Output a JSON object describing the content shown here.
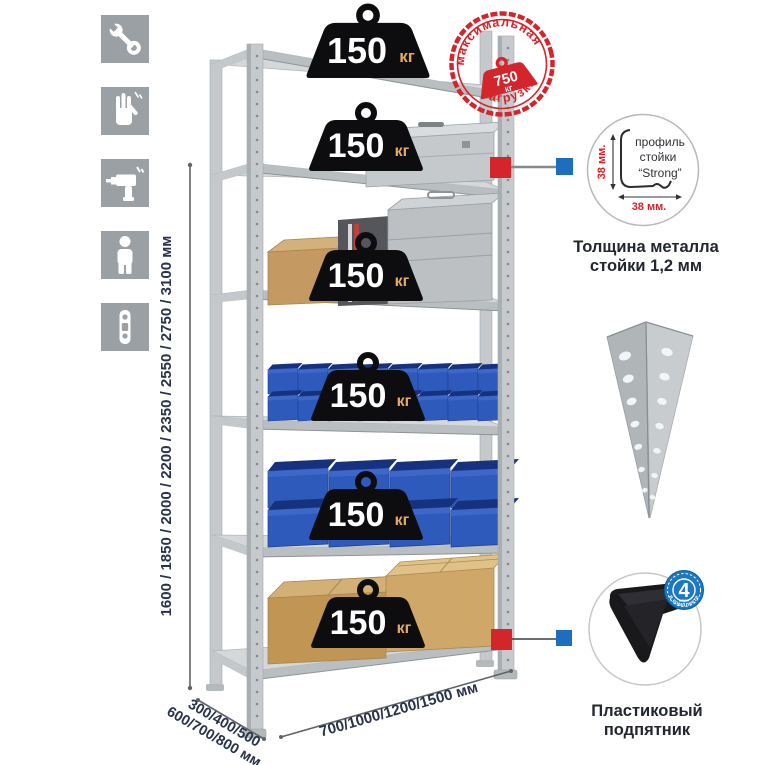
{
  "icons_panel": {
    "items": [
      {
        "name": "wrench"
      },
      {
        "name": "gloves"
      },
      {
        "name": "drill"
      },
      {
        "name": "person"
      },
      {
        "name": "rack-upright-profile"
      }
    ]
  },
  "dimensions": {
    "height": "1600 / 1850 / 2000 / 2200 / 2350 / 2550 / 2750 / 3100 мм",
    "depth_line1": "300/400/500",
    "depth_line2": "600/700/800 мм",
    "width": "700/1000/1200/1500 мм"
  },
  "weights": [
    {
      "value": "150",
      "unit": "кг"
    },
    {
      "value": "150",
      "unit": "кг"
    },
    {
      "value": "150",
      "unit": "кг"
    },
    {
      "value": "150",
      "unit": "кг"
    },
    {
      "value": "150",
      "unit": "кг"
    },
    {
      "value": "150",
      "unit": "кг"
    }
  ],
  "stamp": {
    "arc_top": "максимальная",
    "arc_bottom": "нагрузка",
    "value": "750",
    "unit": "кг"
  },
  "profile_callout": {
    "label1": "профиль",
    "label2": "стойки",
    "label3": "“Strong”",
    "dim_vertical": "38 мм.",
    "dim_horizontal": "38 мм.",
    "caption1": "Толщина металла",
    "caption2": "стойки 1,2 мм"
  },
  "foot_callout": {
    "badge_number": "4",
    "badge_unit": "штуки",
    "badge_arc": "в комплекте",
    "caption1": "Пластиковый",
    "caption2": "подпятник"
  },
  "colors": {
    "accent_red": "#d4252c",
    "accent_blue": "#1d6fbe",
    "metal": "#c2c7ca",
    "bin_blue": "#2e5abc",
    "text_dark": "#28324a"
  }
}
